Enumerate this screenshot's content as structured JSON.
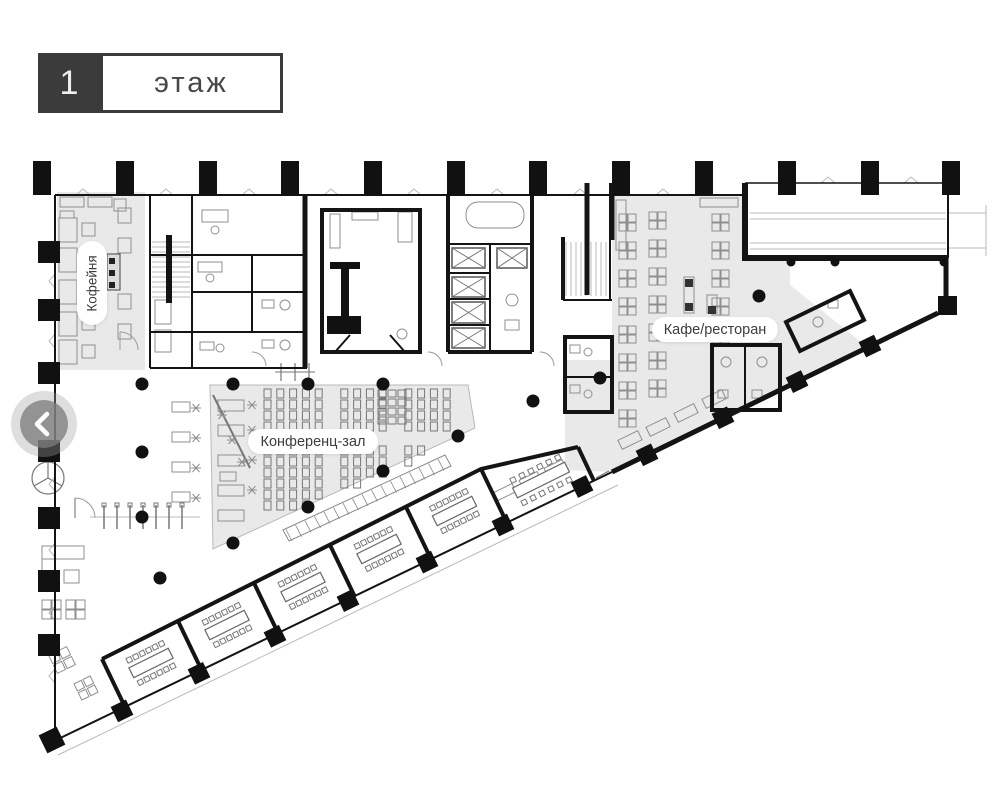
{
  "header": {
    "floor_number": "1",
    "floor_label": "этаж"
  },
  "zones": {
    "coffee": "Кофейня",
    "cafe": "Кафе/ресторан",
    "conference": "Конференц-зал"
  },
  "nav": {
    "prev_icon": "chevron-left-icon"
  },
  "colors": {
    "wall": "#141414",
    "zone_fill": "#e9e9e9",
    "header_dark": "#3b3b3b",
    "furniture": "#909090",
    "nav_button": "#808080"
  }
}
